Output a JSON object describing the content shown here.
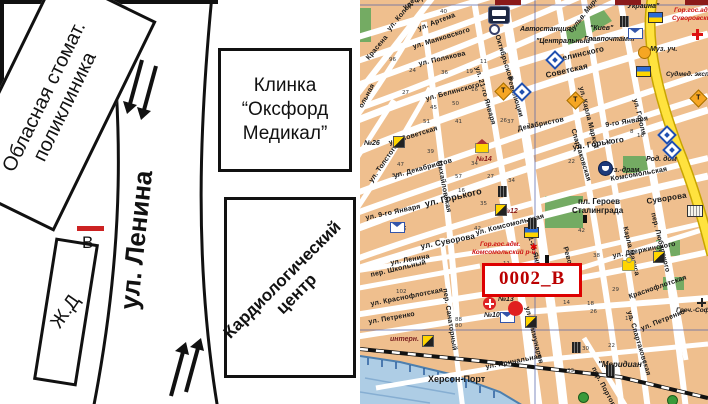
{
  "left": {
    "stomat_line1": "Обласная стомат.",
    "stomat_line2": "поликлиника",
    "clinic_line1": "Клинка",
    "clinic_line2": "“Оксфорд",
    "clinic_line3": "Медикал”",
    "cardio_line1": "Кардиологический",
    "cardio_line2": "центр",
    "railway": "Ж.Д",
    "street": "ул. Ленина",
    "point": "В"
  },
  "map": {
    "callout": "0002_В",
    "streets": [
      {
        "t": "ул. Фрунзе",
        "x": 42,
        "y": 5,
        "r": -27
      },
      {
        "t": "ул. Артема",
        "x": 57,
        "y": 26,
        "r": -21
      },
      {
        "t": "ул. Маяковского",
        "x": 52,
        "y": 44,
        "r": -17
      },
      {
        "t": "ул. Полякова",
        "x": 58,
        "y": 61,
        "r": -13
      },
      {
        "t": "ул. Белинского",
        "x": 65,
        "y": 96,
        "r": -15
      },
      {
        "t": "Белинского",
        "x": 196,
        "y": 56,
        "r": -13,
        "fs": 8
      },
      {
        "t": "ул. Советская",
        "x": 28,
        "y": 140,
        "r": -17
      },
      {
        "t": "Советская",
        "x": 185,
        "y": 72,
        "r": -13,
        "fs": 8
      },
      {
        "t": "ул. Декабристов",
        "x": 33,
        "y": 173,
        "r": -15
      },
      {
        "t": "Декабристов",
        "x": 157,
        "y": 126,
        "r": -12
      },
      {
        "t": "ул. Горького",
        "x": 64,
        "y": 200,
        "r": -13,
        "fs": 9,
        "b": 1
      },
      {
        "t": "ул. Горького",
        "x": 212,
        "y": 144,
        "r": -9,
        "fs": 8
      },
      {
        "t": "ул. 9-го Января",
        "x": 5,
        "y": 215,
        "r": -12
      },
      {
        "t": "9-го Января",
        "x": 245,
        "y": 122,
        "r": -9
      },
      {
        "t": "ул. Суворова",
        "x": 60,
        "y": 243,
        "r": -11,
        "fs": 8
      },
      {
        "t": "Суворова",
        "x": 286,
        "y": 198,
        "r": -9,
        "fs": 8
      },
      {
        "t": "ул. Ленина",
        "x": 30,
        "y": 260,
        "r": -10
      },
      {
        "t": "1-го Мая",
        "x": 178,
        "y": 268,
        "r": -9
      },
      {
        "t": "пер. Школьный",
        "x": 10,
        "y": 272,
        "r": -13
      },
      {
        "t": "ул. Краснофлотская",
        "x": 10,
        "y": 301,
        "r": -11
      },
      {
        "t": "Краснофлотская",
        "x": 268,
        "y": 294,
        "r": -19
      },
      {
        "t": "ул. Петренко",
        "x": 8,
        "y": 319,
        "r": -10
      },
      {
        "t": "ул. Петренко",
        "x": 280,
        "y": 326,
        "r": -22
      },
      {
        "t": "ул. Причальная",
        "x": 125,
        "y": 364,
        "r": -11
      },
      {
        "t": "ул. Дзержинского",
        "x": 252,
        "y": 253,
        "r": -11
      },
      {
        "t": "ул. Комсомольская",
        "x": 115,
        "y": 230,
        "r": -14
      },
      {
        "t": "Комсомольская",
        "x": 250,
        "y": 176,
        "r": -10
      },
      {
        "t": "ул. Колодезная",
        "x": 26,
        "y": 28,
        "r": -50
      },
      {
        "t": "Красена",
        "x": 5,
        "y": 57,
        "r": -50
      },
      {
        "t": "ул. Толстого",
        "x": 8,
        "y": 180,
        "r": -55
      },
      {
        "t": "ольная",
        "x": -2,
        "y": 106,
        "r": -62
      },
      {
        "t": "Октябрьской",
        "x": 140,
        "y": 34,
        "r": 73
      },
      {
        "t": "Революции",
        "x": 152,
        "y": 76,
        "r": 73
      },
      {
        "t": "Революции",
        "x": 208,
        "y": 246,
        "r": 74
      },
      {
        "t": "ул. 21-го Января",
        "x": 120,
        "y": 66,
        "r": 74
      },
      {
        "t": "21-го Января",
        "x": 172,
        "y": 232,
        "r": 74
      },
      {
        "t": "Михайловская",
        "x": 82,
        "y": 160,
        "r": 79
      },
      {
        "t": "Спартаковская",
        "x": 216,
        "y": 128,
        "r": 73
      },
      {
        "t": "ул. Спартаковская",
        "x": 272,
        "y": 310,
        "r": 73
      },
      {
        "t": "ул. Карла Маркса",
        "x": 224,
        "y": 86,
        "r": 76
      },
      {
        "t": "Карла Маркса",
        "x": 268,
        "y": 226,
        "r": 76
      },
      {
        "t": "ул. Гоголя",
        "x": 278,
        "y": 98,
        "r": 76
      },
      {
        "t": "ул. Коммунаров",
        "x": 170,
        "y": 306,
        "r": 76
      },
      {
        "t": "пер. Санаторный",
        "x": 88,
        "y": 288,
        "r": 81
      },
      {
        "t": "пер. Любарского",
        "x": 296,
        "y": 212,
        "r": 76
      },
      {
        "t": "пер. Портовый",
        "x": 236,
        "y": 366,
        "r": 62
      }
    ],
    "places": [
      {
        "t": "Автостанция",
        "x": 160,
        "y": 26
      },
      {
        "t": "\"Центральный\"",
        "x": 176,
        "y": 38
      },
      {
        "t": "\"Киев\"",
        "x": 230,
        "y": 25
      },
      {
        "t": "Главпочтамт",
        "x": 224,
        "y": 36
      },
      {
        "t": "\"Украина\"",
        "x": 264,
        "y": 3,
        "b": 1
      },
      {
        "t": "бульв. Мирный",
        "x": 208,
        "y": 30,
        "r": -52
      },
      {
        "t": "Муз. уч.",
        "x": 290,
        "y": 46
      },
      {
        "t": "Род. дом",
        "x": 286,
        "y": 156
      },
      {
        "t": "Муз.-драм.",
        "x": 244,
        "y": 167
      },
      {
        "t": "пл. Героев",
        "x": 218,
        "y": 198,
        "b": 1,
        "up": 1,
        "fs": 8
      },
      {
        "t": "Сталинграда",
        "x": 212,
        "y": 207,
        "b": 1,
        "up": 1,
        "fs": 8
      },
      {
        "t": "Херсон-Порт",
        "x": 68,
        "y": 375,
        "b": 1,
        "up": 1,
        "fs": 9
      },
      {
        "t": "\"Меридиан\"",
        "x": 238,
        "y": 361,
        "b": 1,
        "fs": 8
      },
      {
        "t": "Греч.-Соф.",
        "x": 316,
        "y": 308,
        "fs": 6.5
      },
      {
        "t": "интерн.",
        "x": 30,
        "y": 336,
        "c": "#7a2020"
      },
      {
        "t": "Гор.гос.адм.",
        "x": 120,
        "y": 242,
        "c": "#cc1111",
        "fs": 6.5
      },
      {
        "t": "Комсомольский р-н",
        "x": 112,
        "y": 250,
        "c": "#cc1111",
        "fs": 6.5
      },
      {
        "t": "Гор.гос.адм.",
        "x": 314,
        "y": 8,
        "c": "#cc1111",
        "fs": 6.5
      },
      {
        "t": "Суворовский р-н",
        "x": 312,
        "y": 16,
        "c": "#cc1111",
        "fs": 6.5
      },
      {
        "t": "Судмед. эксп.",
        "x": 306,
        "y": 72,
        "fs": 6.5
      },
      {
        "t": "№26",
        "x": 4,
        "y": 140,
        "b": 1
      },
      {
        "t": "№14",
        "x": 116,
        "y": 156,
        "b": 1,
        "c": "#8a1a1a"
      },
      {
        "t": "№12",
        "x": 142,
        "y": 208,
        "b": 1,
        "c": "#8a1a1a"
      },
      {
        "t": "№25",
        "x": 30,
        "y": 226,
        "b": 1
      },
      {
        "t": "№10",
        "x": 124,
        "y": 312,
        "b": 1
      },
      {
        "t": "№13",
        "x": 138,
        "y": 296,
        "b": 1
      }
    ],
    "numbers": [
      {
        "t": "96",
        "x": 29,
        "y": 58
      },
      {
        "t": "24",
        "x": 49,
        "y": 69
      },
      {
        "t": "27",
        "x": 42,
        "y": 91
      },
      {
        "t": "40",
        "x": 80,
        "y": 10
      },
      {
        "t": "19",
        "x": 106,
        "y": 70
      },
      {
        "t": "36",
        "x": 81,
        "y": 71
      },
      {
        "t": "45",
        "x": 70,
        "y": 106
      },
      {
        "t": "50",
        "x": 92,
        "y": 102
      },
      {
        "t": "16",
        "x": 111,
        "y": 88
      },
      {
        "t": "51",
        "x": 63,
        "y": 120
      },
      {
        "t": "11",
        "x": 120,
        "y": 60
      },
      {
        "t": "41",
        "x": 95,
        "y": 120
      },
      {
        "t": "39",
        "x": 67,
        "y": 150
      },
      {
        "t": "47",
        "x": 37,
        "y": 163
      },
      {
        "t": "57",
        "x": 95,
        "y": 175
      },
      {
        "t": "58",
        "x": 32,
        "y": 174
      },
      {
        "t": "34",
        "x": 111,
        "y": 162
      },
      {
        "t": "27",
        "x": 127,
        "y": 175
      },
      {
        "t": "16",
        "x": 98,
        "y": 189
      },
      {
        "t": "35",
        "x": 120,
        "y": 202
      },
      {
        "t": "42",
        "x": 114,
        "y": 227
      },
      {
        "t": "26",
        "x": 140,
        "y": 119
      },
      {
        "t": "23",
        "x": 167,
        "y": 124
      },
      {
        "t": "22",
        "x": 208,
        "y": 160
      },
      {
        "t": "34",
        "x": 148,
        "y": 179
      },
      {
        "t": "37",
        "x": 147,
        "y": 120
      },
      {
        "t": "10",
        "x": 277,
        "y": 134
      },
      {
        "t": "8",
        "x": 270,
        "y": 130
      },
      {
        "t": "15",
        "x": 245,
        "y": 140
      },
      {
        "t": "42",
        "x": 218,
        "y": 229
      },
      {
        "t": "38",
        "x": 233,
        "y": 254
      },
      {
        "t": "18",
        "x": 227,
        "y": 302
      },
      {
        "t": "26",
        "x": 230,
        "y": 310
      },
      {
        "t": "29",
        "x": 252,
        "y": 288
      },
      {
        "t": "22",
        "x": 248,
        "y": 344
      },
      {
        "t": "30",
        "x": 222,
        "y": 347
      },
      {
        "t": "33",
        "x": 207,
        "y": 369
      },
      {
        "t": "14",
        "x": 203,
        "y": 301
      },
      {
        "t": "16",
        "x": 265,
        "y": 317
      },
      {
        "t": "102",
        "x": 36,
        "y": 290
      },
      {
        "t": "88",
        "x": 95,
        "y": 318
      },
      {
        "t": "80",
        "x": 95,
        "y": 324
      },
      {
        "t": "11",
        "x": 143,
        "y": 262
      }
    ],
    "icons": [
      {
        "k": "bus",
        "x": 128,
        "y": 6
      },
      {
        "k": "ring",
        "x": 129,
        "y": 24
      },
      {
        "k": "env",
        "x": 30,
        "y": 222
      },
      {
        "k": "env",
        "x": 140,
        "y": 312
      },
      {
        "k": "env",
        "x": 268,
        "y": 28
      },
      {
        "k": "redcross",
        "x": 332,
        "y": 29
      },
      {
        "k": "crosscircle",
        "x": 123,
        "y": 297
      },
      {
        "k": "blackcross",
        "x": 337,
        "y": 298
      },
      {
        "k": "flag",
        "x": 288,
        "y": 12
      },
      {
        "k": "flag",
        "x": 276,
        "y": 66
      },
      {
        "k": "flag",
        "x": 164,
        "y": 227
      },
      {
        "k": "dmdT",
        "x": 209,
        "y": 94
      },
      {
        "k": "dmdT",
        "x": 332,
        "y": 92
      },
      {
        "k": "dmdT",
        "x": 137,
        "y": 85
      },
      {
        "k": "circleT",
        "x": 278,
        "y": 46
      },
      {
        "k": "bluedmd",
        "x": 155,
        "y": 85
      },
      {
        "k": "bluedmd",
        "x": 188,
        "y": 53
      },
      {
        "k": "bluedmd",
        "x": 300,
        "y": 128
      },
      {
        "k": "bluedmd",
        "x": 305,
        "y": 143
      },
      {
        "k": "theater",
        "x": 238,
        "y": 161
      },
      {
        "k": "yb",
        "x": 33,
        "y": 136
      },
      {
        "k": "yb",
        "x": 135,
        "y": 204
      },
      {
        "k": "yb",
        "x": 62,
        "y": 335
      },
      {
        "k": "yb",
        "x": 165,
        "y": 316
      },
      {
        "k": "yb",
        "x": 293,
        "y": 251
      },
      {
        "k": "house",
        "x": 115,
        "y": 143
      },
      {
        "k": "bldg",
        "x": 168,
        "y": 218
      },
      {
        "k": "bldg",
        "x": 208,
        "y": 270
      },
      {
        "k": "bldg",
        "x": 212,
        "y": 342
      },
      {
        "k": "bldg",
        "x": 138,
        "y": 186
      },
      {
        "k": "bldg",
        "x": 246,
        "y": 365
      },
      {
        "k": "bldg",
        "x": 260,
        "y": 16
      },
      {
        "k": "wbldg",
        "x": 327,
        "y": 205
      },
      {
        "k": "church",
        "x": 262,
        "y": 260
      },
      {
        "k": "reddot",
        "x": 148,
        "y": 301
      },
      {
        "k": "redstar",
        "x": 170,
        "y": 243
      },
      {
        "k": "greendot",
        "x": 218,
        "y": 392
      },
      {
        "k": "greendot",
        "x": 307,
        "y": 395
      },
      {
        "k": "dred",
        "x": 135,
        "y": 0
      },
      {
        "k": "dred",
        "x": 255,
        "y": 0
      },
      {
        "k": "dred",
        "x": 325,
        "y": 0
      },
      {
        "k": "monu",
        "x": 223,
        "y": 215
      },
      {
        "k": "monu",
        "x": 185,
        "y": 255
      }
    ]
  }
}
